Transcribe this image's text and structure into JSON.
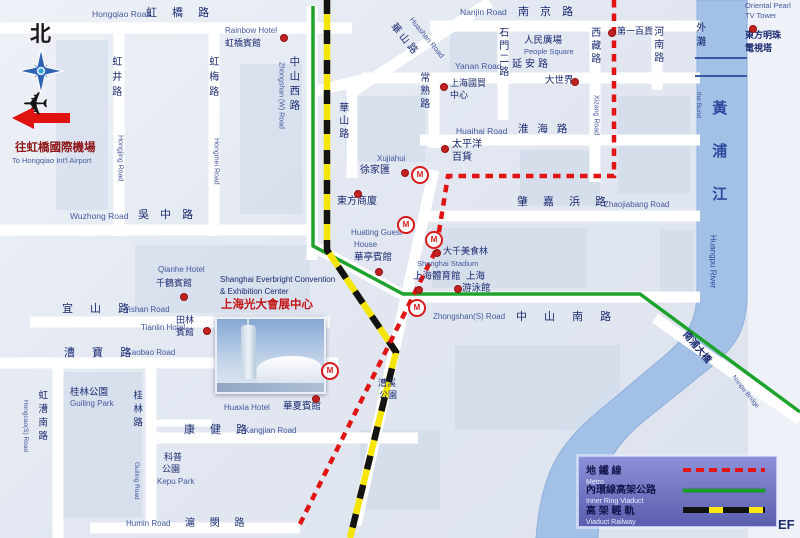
{
  "colors": {
    "navy": "#1a2a70",
    "blue": "#44589e",
    "red": "#c41414",
    "dred": "#8c1616",
    "rblue": "#2b4a9e",
    "black": "#1a1a1a",
    "river_fill": "#a3c0e6",
    "ring_green": "#1da32b",
    "rail_yellow": "#f4e506",
    "metro_red": "#e11414",
    "road_white": "#ffffff"
  },
  "compass": {
    "north": "北"
  },
  "airport": {
    "cn": "往虹橋國際機場",
    "en": "To Hongqiao Int'l Airport"
  },
  "river": {
    "cn": "黃浦江",
    "en": "Huangpu River",
    "bund_cn": "外灘",
    "bund_en": "the Bund"
  },
  "bridge": {
    "cn": "南浦大橋",
    "en": "Nanpu Bridge"
  },
  "legend": {
    "rows": [
      {
        "cn": "地 鐵 線",
        "en": "Metro"
      },
      {
        "cn": "內環線高架公路",
        "en": "Inner Ring Viaduct"
      },
      {
        "cn": "高 架 輕 軌",
        "en": "Viaduct Railway"
      }
    ]
  },
  "watermark": "EF",
  "geometry": {
    "river": "M747,0 L747,295 C747,332 733,350 706,371 L650,416 C617,442 604,463 601,493 L598,538 L536,538 C541,476 557,447 593,416 L656,363 C684,340 697,325 697,292 L697,0 Z",
    "river_bridges": "M695,58 H747 M695,76 H747",
    "roads_main": "M0,28 H352 M430,26 H700 M362,78 H700 M312,92 L365,79 M420,140 H700 M0,230 H318 M425,216 H700 M30,322 H330 M408,297 H700 M0,363 H338 M148,438 H418 M90,528 H300 M119,22 V236 M214,22 V236 M312,6 V260 M352,86 V178 M434,74 V148 M503,22 V120 M595,22 V182 M657,22 V90 M58,358 V538 M151,358 V525 M352,92 L490,2 M434,170 L356,525 M655,318 L800,420 M313,246 L405,296",
    "roads_minor": "M151,423 H212",
    "ring": "M313,6 V246 L403,294 H640 L800,412",
    "rail": "M327,0 V250 L396,352 L350,538",
    "metro": "M614,0 V176 H448 L436,250 L298,528"
  },
  "blocks": [
    [
      748,
      0,
      52,
      538,
      "#eef1f8",
      1
    ],
    [
      345,
      96,
      80,
      66
    ],
    [
      450,
      30,
      48,
      42
    ],
    [
      135,
      245,
      175,
      68
    ],
    [
      432,
      228,
      155,
      60
    ],
    [
      455,
      345,
      165,
      85
    ],
    [
      62,
      372,
      80,
      145
    ],
    [
      618,
      96,
      72,
      98
    ],
    [
      240,
      64,
      62,
      150
    ],
    [
      520,
      150,
      80,
      55
    ],
    [
      56,
      40,
      52,
      170
    ],
    [
      660,
      230,
      34,
      62
    ],
    [
      360,
      430,
      80,
      80
    ]
  ],
  "dots": [
    [
      283,
      37
    ],
    [
      183,
      296
    ],
    [
      443,
      86
    ],
    [
      752,
      28
    ],
    [
      611,
      32
    ],
    [
      574,
      81
    ],
    [
      444,
      148
    ],
    [
      404,
      172
    ],
    [
      357,
      193
    ],
    [
      378,
      271
    ],
    [
      436,
      252
    ],
    [
      418,
      289
    ],
    [
      457,
      288
    ],
    [
      315,
      398
    ],
    [
      206,
      330
    ]
  ],
  "metro_stations": [
    [
      420,
      175
    ],
    [
      406,
      225
    ],
    [
      434,
      240
    ],
    [
      417,
      308
    ],
    [
      330,
      371
    ]
  ],
  "labels": [
    {
      "n": "north-label",
      "t": "北",
      "x": 30,
      "y": 24,
      "fs": 21,
      "c": "black",
      "b": 1
    },
    {
      "n": "airport-label-cn",
      "t": "往虹橋國際機場",
      "x": 15,
      "y": 142,
      "fs": 11.5,
      "c": "dred",
      "b": 1
    },
    {
      "n": "airport-label-en",
      "t": "To Hongqiao Int'l Airport",
      "x": 12,
      "y": 157,
      "fs": 7.5,
      "c": "blue"
    },
    {
      "n": "road-label",
      "t": "Hongqiao Road",
      "x": 92,
      "y": 10,
      "fs": 8.5,
      "c": "blue"
    },
    {
      "n": "road-label",
      "t": "虹 橋 路",
      "x": 146,
      "y": 8,
      "fs": 11,
      "c": "navy",
      "ls": 6
    },
    {
      "n": "poi-rainbow-hotel-en",
      "t": "Rainbow Hotel",
      "x": 225,
      "y": 27,
      "fs": 8,
      "c": "blue"
    },
    {
      "n": "poi-rainbow-hotel-cn",
      "t": "虹橋賓館",
      "x": 225,
      "y": 39,
      "fs": 9,
      "c": "navy"
    },
    {
      "n": "road-label",
      "t": "虹井路",
      "x": 109,
      "y": 56,
      "fs": 10,
      "c": "navy",
      "o": "v",
      "ls": 5
    },
    {
      "n": "road-label",
      "t": "Hongjing Road",
      "x": 116,
      "y": 135,
      "fs": 7,
      "c": "blue",
      "o": "v"
    },
    {
      "n": "road-label",
      "t": "虹梅路",
      "x": 206,
      "y": 56,
      "fs": 10,
      "c": "navy",
      "o": "v",
      "ls": 5
    },
    {
      "n": "road-label",
      "t": "Hongmei Road",
      "x": 212,
      "y": 138,
      "fs": 7,
      "c": "blue",
      "o": "v"
    },
    {
      "n": "road-label",
      "t": "中山西路",
      "x": 288,
      "y": 56,
      "fs": 10.5,
      "c": "navy",
      "o": "v",
      "ls": 4
    },
    {
      "n": "road-label",
      "t": "Zhongshan (W) Road",
      "x": 277,
      "y": 62,
      "fs": 7,
      "c": "blue",
      "o": "v"
    },
    {
      "n": "road-label",
      "t": "華山路",
      "x": 336,
      "y": 102,
      "fs": 10,
      "c": "navy",
      "o": "v",
      "ls": 3
    },
    {
      "n": "road-label",
      "t": "華山路",
      "x": 396,
      "y": 22,
      "fs": 10,
      "c": "navy",
      "rot": 51,
      "ls": 3
    },
    {
      "n": "road-label",
      "t": "Huashan Road",
      "x": 414,
      "y": 16,
      "fs": 7.5,
      "c": "blue",
      "rot": 51
    },
    {
      "n": "road-label",
      "t": "常熟路",
      "x": 417,
      "y": 72,
      "fs": 10,
      "c": "navy",
      "o": "v",
      "ls": 3
    },
    {
      "n": "road-label",
      "t": "Nanjin Road",
      "x": 460,
      "y": 8,
      "fs": 8.5,
      "c": "blue"
    },
    {
      "n": "road-label",
      "t": "南 京 路",
      "x": 518,
      "y": 7,
      "fs": 11,
      "c": "navy",
      "ls": 4
    },
    {
      "n": "poi-people-square-cn",
      "t": "人民廣場",
      "x": 524,
      "y": 36,
      "fs": 9.5,
      "c": "navy"
    },
    {
      "n": "poi-people-square-en",
      "t": "People Square",
      "x": 524,
      "y": 48,
      "fs": 7.5,
      "c": "blue"
    },
    {
      "n": "road-label",
      "t": "Yanan Road",
      "x": 455,
      "y": 62,
      "fs": 8.5,
      "c": "blue"
    },
    {
      "n": "road-label",
      "t": "延安路",
      "x": 512,
      "y": 60,
      "fs": 10,
      "c": "navy",
      "ls": 3
    },
    {
      "n": "road-label",
      "t": "石門二路",
      "x": 496,
      "y": 27,
      "fs": 10,
      "c": "navy",
      "o": "v",
      "ls": 3
    },
    {
      "n": "road-label",
      "t": "西藏路",
      "x": 588,
      "y": 27,
      "fs": 10,
      "c": "navy",
      "o": "v",
      "ls": 3
    },
    {
      "n": "road-label",
      "t": "Xizang Road",
      "x": 592,
      "y": 95,
      "fs": 7,
      "c": "blue",
      "o": "v"
    },
    {
      "n": "road-label",
      "t": "河南路",
      "x": 651,
      "y": 26,
      "fs": 10,
      "c": "navy",
      "o": "v",
      "ls": 3
    },
    {
      "n": "poi-no1-store",
      "t": "第一百貨",
      "x": 617,
      "y": 27,
      "fs": 9,
      "c": "navy"
    },
    {
      "n": "poi-great-world",
      "t": "大世界",
      "x": 545,
      "y": 76,
      "fs": 9.5,
      "c": "navy"
    },
    {
      "n": "poi-bund-cn",
      "t": "外灘",
      "x": 693,
      "y": 22,
      "fs": 10,
      "c": "navy",
      "o": "v",
      "ls": 4
    },
    {
      "n": "poi-bund-en",
      "t": "the Bund",
      "x": 695,
      "y": 92,
      "fs": 6.5,
      "c": "blue",
      "o": "v"
    },
    {
      "n": "poi-tv-tower-en1",
      "t": "Oriental Pearl",
      "x": 745,
      "y": 2,
      "fs": 7.5,
      "c": "blue"
    },
    {
      "n": "poi-tv-tower-en2",
      "t": "TV Tower",
      "x": 745,
      "y": 12,
      "fs": 7.5,
      "c": "blue"
    },
    {
      "n": "poi-tv-tower-cn1",
      "t": "東方明珠",
      "x": 745,
      "y": 31,
      "fs": 9,
      "c": "navy",
      "b": 1
    },
    {
      "n": "poi-tv-tower-cn2",
      "t": "電視塔",
      "x": 745,
      "y": 44,
      "fs": 9,
      "c": "navy",
      "b": 1
    },
    {
      "n": "river-name-cn",
      "t": "黃浦江",
      "x": 710,
      "y": 100,
      "fs": 15,
      "c": "rblue",
      "o": "v",
      "ls": 28,
      "b": 1
    },
    {
      "n": "river-name-en",
      "t": "Huangpu River",
      "x": 708,
      "y": 235,
      "fs": 8,
      "c": "rblue",
      "o": "v"
    },
    {
      "n": "road-label",
      "t": "Huaihai Road",
      "x": 456,
      "y": 127,
      "fs": 8.5,
      "c": "blue"
    },
    {
      "n": "road-label",
      "t": "淮 海 路",
      "x": 518,
      "y": 124,
      "fs": 10.5,
      "c": "navy",
      "ls": 3
    },
    {
      "n": "poi-pacific-cn1",
      "t": "太平洋",
      "x": 452,
      "y": 140,
      "fs": 10,
      "c": "navy"
    },
    {
      "n": "poi-pacific-cn2",
      "t": "百貨",
      "x": 452,
      "y": 153,
      "fs": 10,
      "c": "navy"
    },
    {
      "n": "poi-xujiahui-en",
      "t": "Xujiahui",
      "x": 377,
      "y": 155,
      "fs": 8,
      "c": "blue"
    },
    {
      "n": "poi-xujiahui-cn",
      "t": "徐家匯",
      "x": 360,
      "y": 166,
      "fs": 10,
      "c": "navy"
    },
    {
      "n": "poi-trade-center-cn1",
      "t": "上海國貿",
      "x": 450,
      "y": 79,
      "fs": 9,
      "c": "navy"
    },
    {
      "n": "poi-trade-center-cn2",
      "t": "中心",
      "x": 450,
      "y": 91,
      "fs": 9,
      "c": "navy"
    },
    {
      "n": "road-label",
      "t": "Wuzhong Road",
      "x": 70,
      "y": 212,
      "fs": 8.5,
      "c": "blue"
    },
    {
      "n": "road-label",
      "t": "吳 中 路",
      "x": 138,
      "y": 210,
      "fs": 11,
      "c": "navy",
      "ls": 4
    },
    {
      "n": "poi-oriental-store",
      "t": "東方商廈",
      "x": 337,
      "y": 197,
      "fs": 10,
      "c": "navy"
    },
    {
      "n": "road-label",
      "t": "肇 嘉 浜 路",
      "x": 517,
      "y": 197,
      "fs": 11,
      "c": "navy",
      "ls": 6
    },
    {
      "n": "road-label",
      "t": "Zhaojiabang Road",
      "x": 604,
      "y": 201,
      "fs": 8,
      "c": "blue"
    },
    {
      "n": "poi-huating-en1",
      "t": "Huating Guest",
      "x": 351,
      "y": 229,
      "fs": 8,
      "c": "blue"
    },
    {
      "n": "poi-huating-en2",
      "t": "House",
      "x": 354,
      "y": 241,
      "fs": 8,
      "c": "blue"
    },
    {
      "n": "poi-huating-cn",
      "t": "華亭賓館",
      "x": 354,
      "y": 253,
      "fs": 9.5,
      "c": "navy"
    },
    {
      "n": "poi-daqian",
      "t": "大千美食林",
      "x": 443,
      "y": 247,
      "fs": 9,
      "c": "navy"
    },
    {
      "n": "poi-stadium-en",
      "t": "Shanghai Stadium",
      "x": 417,
      "y": 260,
      "fs": 7.5,
      "c": "blue"
    },
    {
      "n": "poi-stadium-cn",
      "t": "上海體育館",
      "x": 413,
      "y": 272,
      "fs": 9.5,
      "c": "navy"
    },
    {
      "n": "poi-pool-cn1",
      "t": "上海",
      "x": 466,
      "y": 272,
      "fs": 9.5,
      "c": "navy"
    },
    {
      "n": "poi-pool-cn2",
      "t": "游泳館",
      "x": 462,
      "y": 284,
      "fs": 9.5,
      "c": "navy"
    },
    {
      "n": "road-label",
      "t": "Zhongshan(S) Road",
      "x": 433,
      "y": 313,
      "fs": 8,
      "c": "blue"
    },
    {
      "n": "road-label",
      "t": "中 山 南 路",
      "x": 516,
      "y": 312,
      "fs": 11,
      "c": "navy",
      "ls": 7
    },
    {
      "n": "poi-qianhe-en",
      "t": "Qianhe Hotel",
      "x": 158,
      "y": 266,
      "fs": 8,
      "c": "blue"
    },
    {
      "n": "poi-qianhe-cn",
      "t": "千鶴賓館",
      "x": 156,
      "y": 279,
      "fs": 9,
      "c": "navy"
    },
    {
      "n": "road-label",
      "t": "宜 山 路",
      "x": 62,
      "y": 304,
      "fs": 11,
      "c": "navy",
      "ls": 7
    },
    {
      "n": "road-label",
      "t": "Yishan Road",
      "x": 124,
      "y": 306,
      "fs": 8,
      "c": "blue"
    },
    {
      "n": "poi-tianlin-en",
      "t": "Tianlin Hotel",
      "x": 141,
      "y": 324,
      "fs": 8,
      "c": "blue"
    },
    {
      "n": "poi-tianlin-cn1",
      "t": "田林",
      "x": 176,
      "y": 316,
      "fs": 9,
      "c": "navy"
    },
    {
      "n": "poi-tianlin-cn2",
      "t": "賓館",
      "x": 176,
      "y": 328,
      "fs": 9,
      "c": "navy"
    },
    {
      "n": "road-label",
      "t": "漕 寶 路",
      "x": 64,
      "y": 348,
      "fs": 11,
      "c": "navy",
      "ls": 7
    },
    {
      "n": "road-label",
      "t": "Caobao Road",
      "x": 126,
      "y": 349,
      "fs": 8,
      "c": "blue"
    },
    {
      "n": "poi-guilin-park-cn",
      "t": "桂林公園",
      "x": 70,
      "y": 388,
      "fs": 9.5,
      "c": "navy"
    },
    {
      "n": "poi-guilin-park-en",
      "t": "Guiling Park",
      "x": 70,
      "y": 400,
      "fs": 8,
      "c": "blue"
    },
    {
      "n": "road-label",
      "t": "虹漕南路",
      "x": 36,
      "y": 390,
      "fs": 9.5,
      "c": "navy",
      "o": "v",
      "ls": 4
    },
    {
      "n": "road-label",
      "t": "Hongcao(S) Road",
      "x": 22,
      "y": 400,
      "fs": 6.5,
      "c": "blue",
      "o": "v"
    },
    {
      "n": "road-label",
      "t": "桂林路",
      "x": 131,
      "y": 390,
      "fs": 9.5,
      "c": "navy",
      "o": "v",
      "ls": 4
    },
    {
      "n": "road-label",
      "t": "Guiling Road",
      "x": 133,
      "y": 462,
      "fs": 6.5,
      "c": "blue",
      "o": "v"
    },
    {
      "n": "poi-kepu-park-cn1",
      "t": "科普",
      "x": 164,
      "y": 453,
      "fs": 9,
      "c": "navy"
    },
    {
      "n": "poi-kepu-park-cn2",
      "t": "公園",
      "x": 162,
      "y": 465,
      "fs": 9,
      "c": "navy"
    },
    {
      "n": "poi-kepu-park-en",
      "t": "Kepu Park",
      "x": 157,
      "y": 478,
      "fs": 8,
      "c": "blue"
    },
    {
      "n": "road-label",
      "t": "康 健 路",
      "x": 184,
      "y": 425,
      "fs": 11,
      "c": "navy",
      "ls": 6
    },
    {
      "n": "road-label",
      "t": "Kangjian Road",
      "x": 244,
      "y": 427,
      "fs": 8,
      "c": "blue"
    },
    {
      "n": "poi-huaxia-en",
      "t": "Huaxia Hotel",
      "x": 224,
      "y": 404,
      "fs": 8,
      "c": "blue"
    },
    {
      "n": "poi-huaxia-cn",
      "t": "華夏賓館",
      "x": 283,
      "y": 402,
      "fs": 9.5,
      "c": "navy"
    },
    {
      "n": "road-label",
      "t": "Humin Road",
      "x": 126,
      "y": 520,
      "fs": 8,
      "c": "blue"
    },
    {
      "n": "road-label",
      "t": "滬 閔 路",
      "x": 185,
      "y": 519,
      "fs": 10,
      "c": "navy",
      "ls": 6
    },
    {
      "n": "poi-caoxi-park-cn1",
      "t": "漕溪",
      "x": 378,
      "y": 379,
      "fs": 9,
      "c": "navy"
    },
    {
      "n": "poi-caoxi-park-cn2",
      "t": "公園",
      "x": 379,
      "y": 391,
      "fs": 9,
      "c": "navy"
    },
    {
      "n": "poi-everbright-en1",
      "t": "Shanghai Everbright Convention",
      "x": 220,
      "y": 276,
      "fs": 8,
      "c": "navy"
    },
    {
      "n": "poi-everbright-en2",
      "t": "& Exhibition Center",
      "x": 220,
      "y": 288,
      "fs": 8,
      "c": "navy"
    },
    {
      "n": "poi-everbright-cn",
      "t": "上海光大會展中心",
      "x": 221,
      "y": 299,
      "fs": 11.5,
      "c": "red",
      "b": 1
    },
    {
      "n": "bridge-label-cn",
      "t": "南浦大橋",
      "x": 688,
      "y": 330,
      "fs": 9.5,
      "c": "navy",
      "rot": 50,
      "b": 1
    },
    {
      "n": "bridge-label-en",
      "t": "Nanpu Bridge",
      "x": 736,
      "y": 374,
      "fs": 6.5,
      "c": "blue",
      "rot": 52
    }
  ]
}
